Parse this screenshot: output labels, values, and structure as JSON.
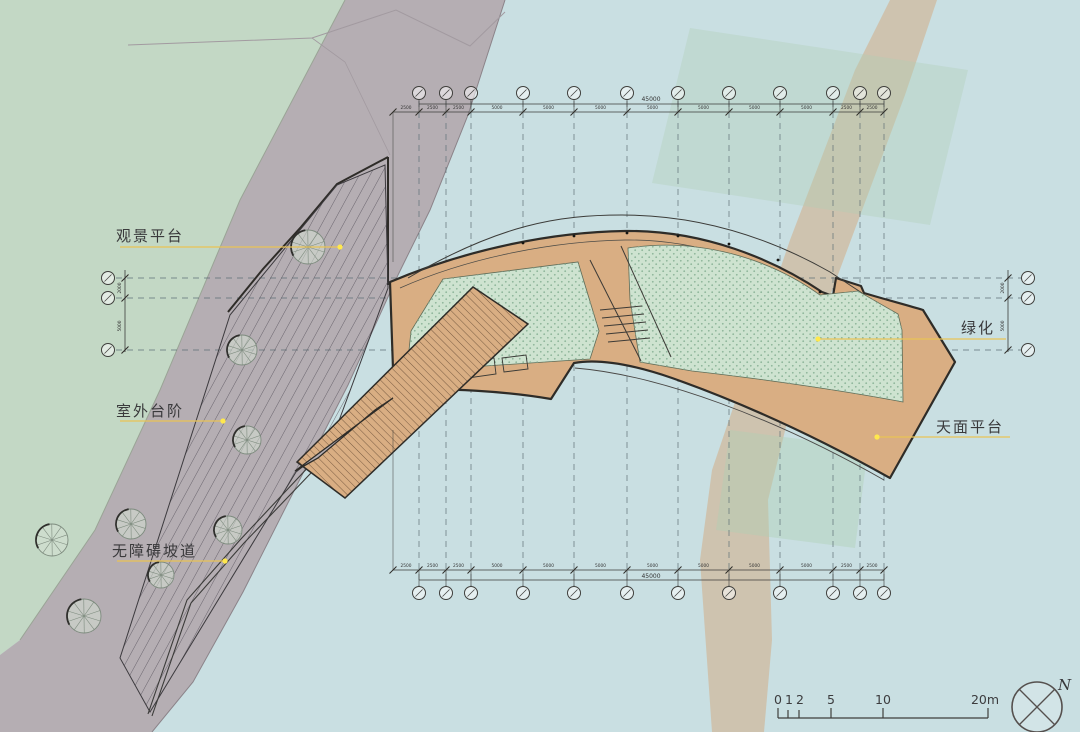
{
  "drawing": {
    "type": "architectural-site-plan",
    "labels": {
      "viewing_platform": "观景平台",
      "outdoor_steps": "室外台阶",
      "barrier_free_ramp": "无障碍坡道",
      "greening": "绿化",
      "roof_platform": "天面平台"
    },
    "grid": {
      "top_total": "45000",
      "bottom_total": "45000",
      "top_segments": [
        "2500",
        "2500",
        "2500",
        "5000",
        "5000",
        "5000",
        "5000",
        "5000",
        "5000",
        "5000",
        "2500",
        "2500"
      ],
      "bottom_segments": [
        "2500",
        "2500",
        "2500",
        "5000",
        "5000",
        "5000",
        "5000",
        "5000",
        "5000",
        "5000",
        "2500",
        "2500"
      ],
      "left_segments": [
        "2000",
        "5000"
      ],
      "right_segments": [
        "2000",
        "5000"
      ]
    },
    "scale_bar": {
      "labels": [
        "0",
        "1",
        "2",
        "5",
        "10",
        "20m"
      ]
    },
    "north": {
      "label": "N"
    },
    "colors": {
      "water": "#c9dfe2",
      "vegetated_land": "#c3d8c5",
      "paved_land": "#b5aeb3",
      "deck": "#d9ae83",
      "green_roof": "#cee3d0",
      "leader_yellow": "#e9c355",
      "leader_dot": "#ffe84d",
      "outline": "#2e2c28"
    }
  }
}
